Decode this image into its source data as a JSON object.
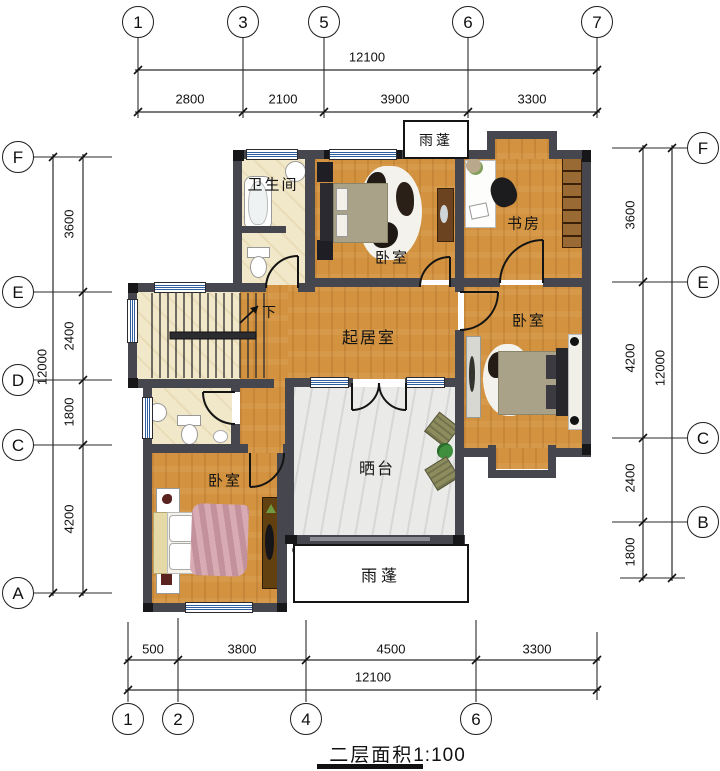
{
  "title": {
    "label": "二层面积",
    "scale": "1:100"
  },
  "grid": {
    "top": {
      "bubbles": [
        "1",
        "3",
        "5",
        "6",
        "7"
      ],
      "total": "12100",
      "segs": [
        "2800",
        "2100",
        "3900",
        "3300"
      ]
    },
    "bottom": {
      "bubbles": [
        "1",
        "2",
        "4",
        "6"
      ],
      "total": "12100",
      "segs": [
        "500",
        "3800",
        "4500",
        "3300"
      ]
    },
    "left": {
      "bubbles": [
        "F",
        "E",
        "D",
        "C",
        "A"
      ],
      "total": "12000",
      "segs": [
        "3600",
        "2400",
        "1800",
        "4200"
      ]
    },
    "right": {
      "bubbles": [
        "F",
        "E",
        "C",
        "B"
      ],
      "total": "12000",
      "segs": [
        "3600",
        "4200",
        "2400",
        "1800"
      ]
    }
  },
  "rooms": {
    "bathroom": "卫生间",
    "bedroom_top": "卧室",
    "study": "书房",
    "living": "起居室",
    "bedroom_right": "卧室",
    "bedroom_bottom": "卧室",
    "terrace": "晒台",
    "canopy_top": "雨蓬",
    "canopy_bottom": "雨蓬",
    "stairs_down": "下"
  },
  "colors": {
    "wall": "#46464e",
    "wood_floor": "#d2923f",
    "tile_floor": "#f1e7c9",
    "marble_floor": "#eaeae8",
    "window_blue": "#2f5f9e",
    "pink_bed": "#cfa0a6",
    "green_duvet": "#a9a289",
    "shelf_brown": "#7c4a1d"
  }
}
